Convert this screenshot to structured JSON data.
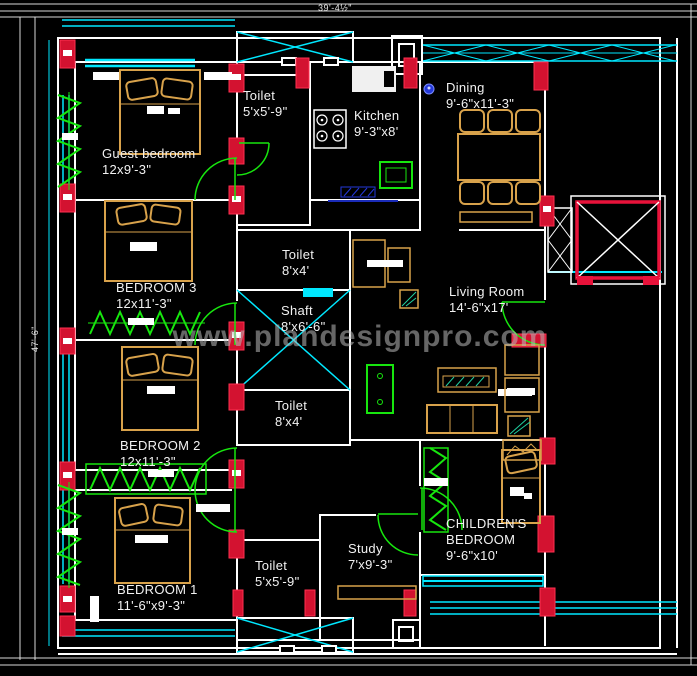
{
  "watermark": {
    "text": "www.plandesignpro.com",
    "color": "#b9b9b9"
  },
  "dimensions": {
    "top": "39'-4½\"",
    "left": "47'-6\""
  },
  "colors": {
    "background": "#000000",
    "wall": "#ffffff",
    "window_glass": "#00e8ff",
    "column": "#d31230",
    "furniture": "#d8a24b",
    "door_plant_green": "#17e60e",
    "lift": "#e8123a",
    "blue_accent": "#2438d8",
    "label_text": "#f2f2f2"
  },
  "rooms": [
    {
      "id": "guest-bedroom",
      "name": "Guest bedroom",
      "dims": "12x9'-3\""
    },
    {
      "id": "toilet-top",
      "name": "Toilet",
      "dims": "5'x5'-9\""
    },
    {
      "id": "kitchen",
      "name": "Kitchen",
      "dims": "9'-3\"x8'"
    },
    {
      "id": "dining",
      "name": "Dining",
      "dims": "9'-6\"x11'-3\""
    },
    {
      "id": "bedroom-3",
      "name": "BEDROOM 3",
      "dims": "12x11'-3\""
    },
    {
      "id": "toilet-upper",
      "name": "Toilet",
      "dims": "8'x4'"
    },
    {
      "id": "shaft",
      "name": "Shaft",
      "dims": "8'x6'-6\""
    },
    {
      "id": "living-room",
      "name": "Living Room",
      "dims": "14'-6\"x17'"
    },
    {
      "id": "toilet-lower",
      "name": "Toilet",
      "dims": "8'x4'"
    },
    {
      "id": "bedroom-2",
      "name": "BEDROOM 2",
      "dims": "12x11'-3\""
    },
    {
      "id": "bedroom-1",
      "name": "BEDROOM 1",
      "dims": "11'-6\"x9'-3\""
    },
    {
      "id": "toilet-bottom",
      "name": "Toilet",
      "dims": "5'x5'-9\""
    },
    {
      "id": "study",
      "name": "Study",
      "dims": "7'x9'-3\""
    },
    {
      "id": "childrens-bedroom",
      "name": "CHILDREN'S\nBEDROOM",
      "dims": "9'-6\"x10'"
    }
  ]
}
